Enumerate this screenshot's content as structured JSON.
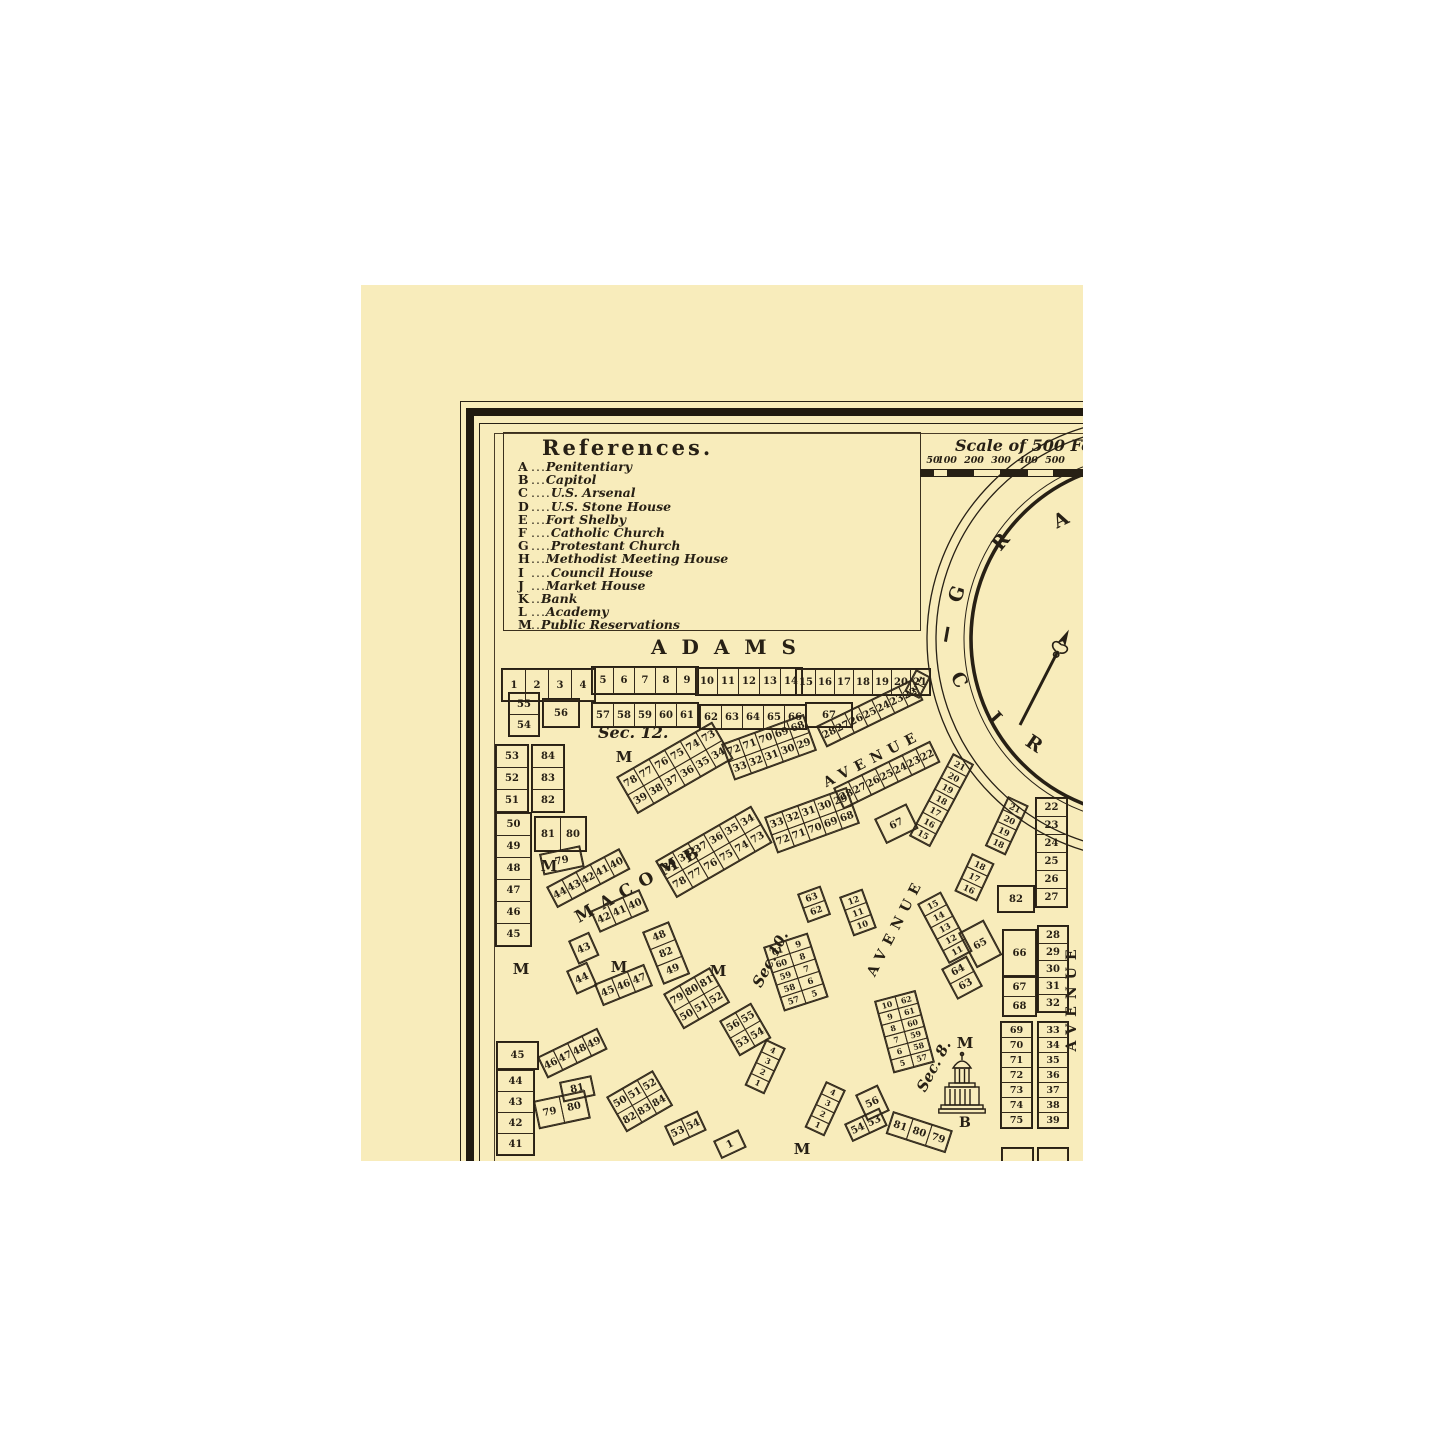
{
  "colors": {
    "paper": "#f8ecbb",
    "ink": "#272015",
    "page": "#ffffff"
  },
  "references": {
    "title": "References.",
    "entries": [
      {
        "key": "A",
        "dots": "...",
        "name": "Penitentiary"
      },
      {
        "key": "B",
        "dots": "...",
        "name": "Capitol"
      },
      {
        "key": "C",
        "dots": "....",
        "name": "U.S. Arsenal"
      },
      {
        "key": "D",
        "dots": "....",
        "name": "U.S. Stone House"
      },
      {
        "key": "E",
        "dots": "...",
        "name": "Fort Shelby"
      },
      {
        "key": "F",
        "dots": "....",
        "name": "Catholic Church"
      },
      {
        "key": "G",
        "dots": "....",
        "name": "Protestant Church"
      },
      {
        "key": "H",
        "dots": "...",
        "name": "Methodist Meeting House"
      },
      {
        "key": "I",
        "dots": "....",
        "name": "Council House"
      },
      {
        "key": "J",
        "dots": "...",
        "name": "Market House"
      },
      {
        "key": "K",
        "dots": "..",
        "name": "Bank"
      },
      {
        "key": "L",
        "dots": "...",
        "name": "Academy"
      },
      {
        "key": "M",
        "dots": "..",
        "name": "Public Reservations"
      }
    ]
  },
  "scale": {
    "title": "Scale of 500 Fee",
    "ticks": [
      {
        "label": "50",
        "x": 572
      },
      {
        "label": "100",
        "x": 586
      },
      {
        "label": "200",
        "x": 613
      },
      {
        "label": "300",
        "x": 640
      },
      {
        "label": "400",
        "x": 667
      },
      {
        "label": "500",
        "x": 694
      }
    ],
    "segments": [
      {
        "w": 13,
        "dark": true
      },
      {
        "w": 14,
        "dark": false
      },
      {
        "w": 27,
        "dark": true
      },
      {
        "w": 27,
        "dark": false
      },
      {
        "w": 27,
        "dark": true
      },
      {
        "w": 27,
        "dark": false
      },
      {
        "w": 35,
        "dark": true
      }
    ]
  },
  "circus": {
    "letters": [
      {
        "ch": "G",
        "x": 585,
        "y": 298,
        "rot": -72
      },
      {
        "ch": "R",
        "x": 629,
        "y": 246,
        "rot": -50
      },
      {
        "ch": "A",
        "x": 689,
        "y": 224,
        "rot": -26
      },
      {
        "ch": "C",
        "x": 587,
        "y": 384,
        "rot": 62
      },
      {
        "ch": "I",
        "x": 623,
        "y": 422,
        "rot": 48
      },
      {
        "ch": "R",
        "x": 662,
        "y": 448,
        "rot": 34
      }
    ]
  },
  "street_labels": [
    {
      "text": "ADAMS",
      "x": 285,
      "y": 350,
      "w": 170,
      "rot": 0,
      "size": 20,
      "ls": 15
    },
    {
      "text": "MACOMB",
      "x": 205,
      "y": 588,
      "w": 150,
      "rot": -29,
      "size": 17,
      "ls": 9
    },
    {
      "text": "AVENUE",
      "x": 452,
      "y": 466,
      "w": 120,
      "rot": -27,
      "size": 14,
      "ls": 7
    },
    {
      "text": "AVENUE",
      "x": 475,
      "y": 634,
      "w": 120,
      "rot": -63,
      "size": 14,
      "ls": 7
    },
    {
      "text": "AVENUE",
      "x": 651,
      "y": 704,
      "w": 120,
      "rot": -90,
      "size": 14,
      "ls": 7
    }
  ],
  "section_labels": [
    {
      "text": "Sec. 12.",
      "x": 237,
      "y": 438,
      "rot": 0,
      "size": 16
    },
    {
      "text": "Sec.10.",
      "x": 379,
      "y": 665,
      "rot": -63,
      "size": 15
    },
    {
      "text": "Sec. 8.",
      "x": 545,
      "y": 772,
      "rot": -62,
      "size": 15
    }
  ],
  "reservation_markers": [
    {
      "x": 263,
      "y": 472
    },
    {
      "x": 188,
      "y": 581
    },
    {
      "x": 160,
      "y": 684
    },
    {
      "x": 258,
      "y": 682
    },
    {
      "x": 357,
      "y": 686
    },
    {
      "x": 604,
      "y": 758
    },
    {
      "x": 441,
      "y": 864
    }
  ],
  "capitol": {
    "label": "B"
  },
  "blocks": [
    {
      "x": 140,
      "y": 383,
      "rot": 0,
      "cw": 24,
      "ch": 32,
      "rows": [
        [
          "1",
          "2",
          "3",
          "4"
        ]
      ]
    },
    {
      "x": 147,
      "y": 407,
      "rot": 0,
      "cw": 30,
      "ch": 22,
      "rows": [
        [
          "55"
        ],
        [
          "54"
        ]
      ]
    },
    {
      "x": 181,
      "y": 413,
      "rot": 0,
      "cw": 36,
      "ch": 28,
      "rows": [
        [
          "56"
        ]
      ]
    },
    {
      "x": 230,
      "y": 381,
      "rot": 0,
      "cw": 22,
      "ch": 27,
      "rows": [
        [
          "5",
          "6",
          "7",
          "8",
          "9"
        ]
      ]
    },
    {
      "x": 230,
      "y": 417,
      "rot": 0,
      "cw": 22,
      "ch": 24,
      "rows": [
        [
          "57",
          "58",
          "59",
          "60",
          "61"
        ]
      ]
    },
    {
      "x": 334,
      "y": 382,
      "rot": 0,
      "cw": 22,
      "ch": 27,
      "rows": [
        [
          "10",
          "11",
          "12",
          "13",
          "14"
        ]
      ]
    },
    {
      "x": 338,
      "y": 419,
      "rot": 0,
      "cw": 22,
      "ch": 24,
      "rows": [
        [
          "62",
          "63",
          "64",
          "65",
          "66"
        ]
      ]
    },
    {
      "x": 434,
      "y": 383,
      "rot": 0,
      "cw": 20,
      "ch": 26,
      "rows": [
        [
          "15",
          "16",
          "17",
          "18",
          "19",
          "20",
          "21"
        ]
      ]
    },
    {
      "x": 444,
      "y": 417,
      "rot": 0,
      "cw": 46,
      "ch": 24,
      "rows": [
        [
          "67"
        ]
      ]
    },
    {
      "x": 455,
      "y": 441,
      "rot": -26,
      "cw": 16,
      "ch": 22,
      "rows": [
        [
          "28",
          "27",
          "26",
          "25",
          "24",
          "23",
          "22"
        ]
      ]
    },
    {
      "x": 472,
      "y": 503,
      "rot": -26,
      "cw": 16,
      "ch": 22,
      "rows": [
        [
          "28",
          "27",
          "26",
          "25",
          "24",
          "23",
          "22"
        ]
      ]
    },
    {
      "x": 592,
      "y": 468,
      "rot": 28,
      "cw": 22,
      "ch": 14,
      "rows": [
        [
          "21"
        ],
        [
          "20"
        ],
        [
          "19"
        ],
        [
          "18"
        ],
        [
          "17"
        ],
        [
          "16"
        ],
        [
          "15"
        ]
      ]
    },
    {
      "x": 513,
      "y": 534,
      "rot": -26,
      "cw": 34,
      "ch": 26,
      "rows": [
        [
          "67"
        ]
      ]
    },
    {
      "x": 360,
      "y": 459,
      "rot": -20,
      "cw": 18,
      "ch": 19,
      "rows": [
        [
          "72",
          "71",
          "70",
          "69",
          "68"
        ],
        [
          "33",
          "32",
          "31",
          "30",
          "29"
        ]
      ]
    },
    {
      "x": 403,
      "y": 532,
      "rot": -20,
      "cw": 18,
      "ch": 19,
      "rows": [
        [
          "33",
          "32",
          "31",
          "30",
          "29"
        ],
        [
          "72",
          "71",
          "70",
          "69",
          "68"
        ]
      ]
    },
    {
      "x": 255,
      "y": 492,
      "rot": -30,
      "cw": 19,
      "ch": 21,
      "rows": [
        [
          "78",
          "77",
          "76",
          "75",
          "74",
          "73"
        ],
        [
          "39",
          "38",
          "37",
          "36",
          "35",
          "34"
        ]
      ]
    },
    {
      "x": 294,
      "y": 576,
      "rot": -30,
      "cw": 19,
      "ch": 21,
      "rows": [
        [
          "39",
          "38",
          "37",
          "36",
          "35",
          "34"
        ],
        [
          "78",
          "77",
          "76",
          "75",
          "74",
          "73"
        ]
      ]
    },
    {
      "x": 134,
      "y": 459,
      "rot": 0,
      "cw": 32,
      "ch": 23,
      "rows": [
        [
          "53"
        ],
        [
          "52"
        ],
        [
          "51"
        ]
      ]
    },
    {
      "x": 170,
      "y": 459,
      "rot": 0,
      "cw": 32,
      "ch": 23,
      "rows": [
        [
          "84"
        ],
        [
          "83"
        ],
        [
          "82"
        ]
      ]
    },
    {
      "x": 134,
      "y": 527,
      "rot": 0,
      "cw": 35,
      "ch": 23,
      "rows": [
        [
          "50"
        ],
        [
          "49"
        ],
        [
          "48"
        ],
        [
          "47"
        ],
        [
          "46"
        ],
        [
          "45"
        ]
      ]
    },
    {
      "x": 173,
      "y": 531,
      "rot": 0,
      "cw": 26,
      "ch": 34,
      "rows": [
        [
          "81",
          "80"
        ]
      ]
    },
    {
      "x": 178,
      "y": 569,
      "rot": -12,
      "cw": 40,
      "ch": 20,
      "rows": [
        [
          "79"
        ]
      ]
    },
    {
      "x": 185,
      "y": 602,
      "rot": -28,
      "cw": 17,
      "ch": 22,
      "rows": [
        [
          "44",
          "43",
          "42",
          "41",
          "40"
        ]
      ]
    },
    {
      "x": 229,
      "y": 626,
      "rot": -24,
      "cw": 18,
      "ch": 22,
      "rows": [
        [
          "42",
          "41",
          "40"
        ]
      ]
    },
    {
      "x": 207,
      "y": 656,
      "rot": -24,
      "cw": 21,
      "ch": 24,
      "rows": [
        [
          "43"
        ]
      ]
    },
    {
      "x": 205,
      "y": 686,
      "rot": -24,
      "cw": 21,
      "ch": 24,
      "rows": [
        [
          "44"
        ]
      ]
    },
    {
      "x": 233,
      "y": 699,
      "rot": -22,
      "cw": 18,
      "ch": 22,
      "rows": [
        [
          "45",
          "46",
          "47"
        ]
      ]
    },
    {
      "x": 281,
      "y": 647,
      "rot": -22,
      "cw": 27,
      "ch": 19,
      "rows": [
        [
          "48"
        ],
        [
          "82"
        ],
        [
          "49"
        ]
      ]
    },
    {
      "x": 402,
      "y": 662,
      "rot": -18,
      "cw": 23,
      "ch": 14,
      "rows": [
        [
          "61",
          "9"
        ],
        [
          "60",
          "8"
        ],
        [
          "59",
          "7"
        ],
        [
          "58",
          "6"
        ],
        [
          "57",
          "5"
        ]
      ]
    },
    {
      "x": 302,
      "y": 709,
      "rot": -30,
      "cw": 18,
      "ch": 20,
      "rows": [
        [
          "79",
          "80",
          "81"
        ],
        [
          "50",
          "51",
          "52"
        ]
      ]
    },
    {
      "x": 358,
      "y": 736,
      "rot": -30,
      "cw": 18,
      "ch": 20,
      "rows": [
        [
          "56",
          "55"
        ],
        [
          "53",
          "54"
        ]
      ]
    },
    {
      "x": 405,
      "y": 754,
      "rot": 25,
      "cw": 20,
      "ch": 13,
      "rows": [
        [
          "4"
        ],
        [
          "3"
        ],
        [
          "2"
        ],
        [
          "1"
        ]
      ]
    },
    {
      "x": 513,
      "y": 716,
      "rot": -15,
      "cw": 21,
      "ch": 13,
      "rows": [
        [
          "10",
          "62"
        ],
        [
          "9",
          "61"
        ],
        [
          "8",
          "60"
        ],
        [
          "7",
          "59"
        ],
        [
          "6",
          "58"
        ],
        [
          "5",
          "57"
        ]
      ]
    },
    {
      "x": 647,
      "y": 511,
      "rot": 25,
      "cw": 21,
      "ch": 14,
      "rows": [
        [
          "21"
        ],
        [
          "20"
        ],
        [
          "19"
        ],
        [
          "18"
        ]
      ]
    },
    {
      "x": 636,
      "y": 600,
      "rot": 0,
      "cw": 36,
      "ch": 26,
      "rows": [
        [
          "82"
        ]
      ]
    },
    {
      "x": 674,
      "y": 512,
      "rot": 0,
      "cw": 31,
      "ch": 19,
      "rows": [
        [
          "22"
        ],
        [
          "23"
        ],
        [
          "24"
        ],
        [
          "25"
        ],
        [
          "26"
        ],
        [
          "27"
        ]
      ]
    },
    {
      "x": 641,
      "y": 644,
      "rot": 0,
      "cw": 33,
      "ch": 46,
      "rows": [
        [
          "66"
        ]
      ]
    },
    {
      "x": 641,
      "y": 691,
      "rot": 0,
      "cw": 33,
      "ch": 20,
      "rows": [
        [
          "67"
        ],
        [
          "68"
        ]
      ]
    },
    {
      "x": 676,
      "y": 640,
      "rot": 0,
      "cw": 30,
      "ch": 18,
      "rows": [
        [
          "28"
        ],
        [
          "29"
        ],
        [
          "30"
        ],
        [
          "31"
        ],
        [
          "32"
        ]
      ]
    },
    {
      "x": 639,
      "y": 736,
      "rot": 0,
      "cw": 31,
      "ch": 16,
      "rows": [
        [
          "69"
        ],
        [
          "70"
        ],
        [
          "71"
        ],
        [
          "72"
        ],
        [
          "73"
        ],
        [
          "74"
        ],
        [
          "75"
        ]
      ]
    },
    {
      "x": 676,
      "y": 736,
      "rot": 0,
      "cw": 30,
      "ch": 16,
      "rows": [
        [
          "33"
        ],
        [
          "34"
        ],
        [
          "35"
        ],
        [
          "36"
        ],
        [
          "37"
        ],
        [
          "38"
        ],
        [
          "39"
        ]
      ]
    },
    {
      "x": 556,
      "y": 619,
      "rot": -28,
      "cw": 25,
      "ch": 14,
      "rows": [
        [
          "15"
        ],
        [
          "14"
        ],
        [
          "13"
        ],
        [
          "12"
        ],
        [
          "11"
        ]
      ]
    },
    {
      "x": 597,
      "y": 648,
      "rot": -28,
      "cw": 27,
      "ch": 38,
      "rows": [
        [
          "65"
        ]
      ]
    },
    {
      "x": 580,
      "y": 684,
      "rot": -28,
      "cw": 27,
      "ch": 17,
      "rows": [
        [
          "64"
        ],
        [
          "63"
        ]
      ]
    },
    {
      "x": 611,
      "y": 568,
      "rot": 25,
      "cw": 23,
      "ch": 14,
      "rows": [
        [
          "18"
        ],
        [
          "17"
        ],
        [
          "16"
        ]
      ]
    },
    {
      "x": 436,
      "y": 609,
      "rot": -20,
      "cw": 23,
      "ch": 15,
      "rows": [
        [
          "63"
        ],
        [
          "62"
        ]
      ]
    },
    {
      "x": 478,
      "y": 612,
      "rot": -20,
      "cw": 23,
      "ch": 14,
      "rows": [
        [
          "12"
        ],
        [
          "11"
        ],
        [
          "10"
        ]
      ]
    },
    {
      "x": 135,
      "y": 756,
      "rot": 0,
      "cw": 41,
      "ch": 27,
      "rows": [
        [
          "45"
        ]
      ]
    },
    {
      "x": 135,
      "y": 784,
      "rot": 0,
      "cw": 37,
      "ch": 22,
      "rows": [
        [
          "44"
        ],
        [
          "43"
        ],
        [
          "42"
        ],
        [
          "41"
        ]
      ]
    },
    {
      "x": 176,
      "y": 772,
      "rot": -26,
      "cw": 17,
      "ch": 22,
      "rows": [
        [
          "46",
          "47",
          "48",
          "49"
        ]
      ]
    },
    {
      "x": 172,
      "y": 816,
      "rot": -12,
      "cw": 26,
      "ch": 27,
      "rows": [
        [
          "79",
          "80"
        ]
      ]
    },
    {
      "x": 198,
      "y": 797,
      "rot": -12,
      "cw": 31,
      "ch": 19,
      "rows": [
        [
          "81"
        ]
      ]
    },
    {
      "x": 245,
      "y": 812,
      "rot": -30,
      "cw": 18,
      "ch": 20,
      "rows": [
        [
          "50",
          "51",
          "52"
        ],
        [
          "82",
          "83",
          "84"
        ]
      ]
    },
    {
      "x": 303,
      "y": 841,
      "rot": -25,
      "cw": 18,
      "ch": 20,
      "rows": [
        [
          "53",
          "54"
        ]
      ]
    },
    {
      "x": 352,
      "y": 856,
      "rot": -25,
      "cw": 26,
      "ch": 18,
      "rows": [
        [
          "1"
        ]
      ]
    },
    {
      "x": 465,
      "y": 796,
      "rot": 25,
      "cw": 20,
      "ch": 13,
      "rows": [
        [
          "4"
        ],
        [
          "3"
        ],
        [
          "2"
        ],
        [
          "1"
        ]
      ]
    },
    {
      "x": 494,
      "y": 810,
      "rot": -25,
      "cw": 23,
      "ch": 27,
      "rows": [
        [
          "56"
        ]
      ]
    },
    {
      "x": 483,
      "y": 839,
      "rot": -25,
      "cw": 19,
      "ch": 18,
      "rows": [
        [
          "54",
          "53"
        ]
      ]
    },
    {
      "x": 532,
      "y": 826,
      "rot": 18,
      "cw": 21,
      "ch": 22,
      "rows": [
        [
          "81",
          "80",
          "79"
        ]
      ]
    },
    {
      "x": 555,
      "y": 384,
      "rot": 28,
      "cw": 15,
      "ch": 12,
      "rows": [
        [
          "1"
        ],
        [
          "2"
        ]
      ]
    },
    {
      "x": 640,
      "y": 862,
      "rot": 0,
      "cw": 31,
      "ch": 14,
      "rows": [
        [
          ""
        ]
      ]
    },
    {
      "x": 676,
      "y": 862,
      "rot": 0,
      "cw": 30,
      "ch": 14,
      "rows": [
        [
          ""
        ]
      ]
    }
  ]
}
